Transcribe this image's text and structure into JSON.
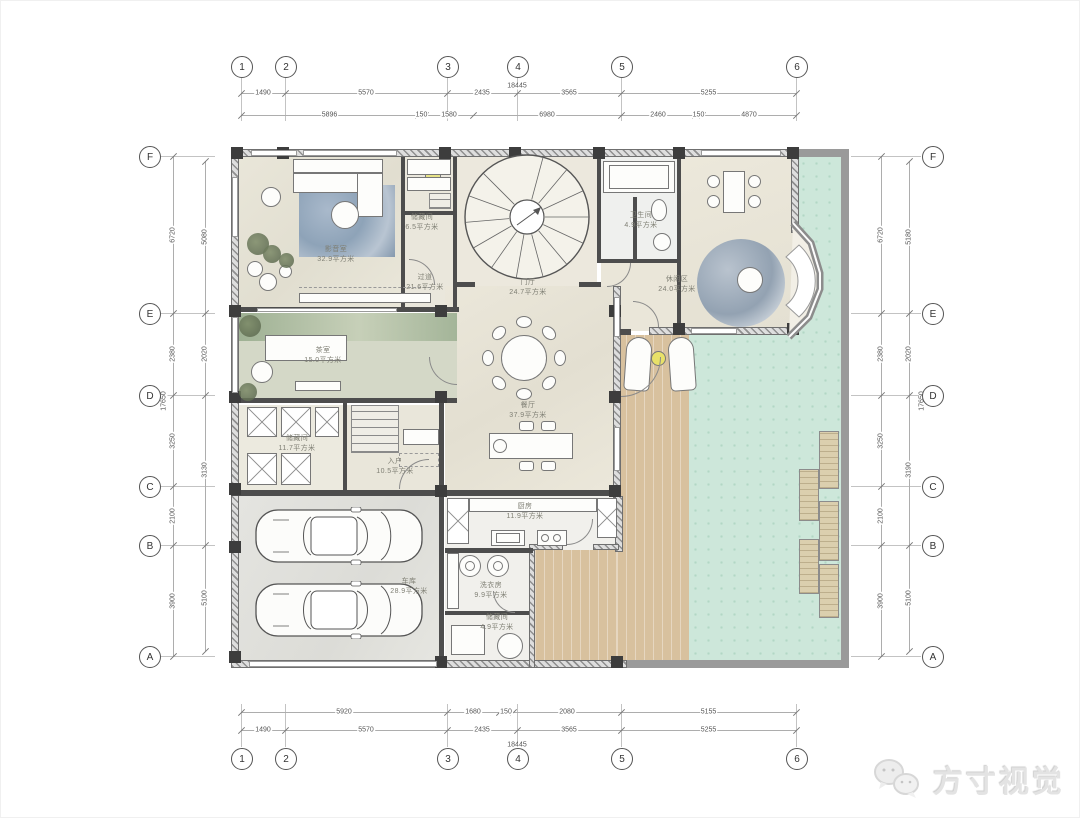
{
  "watermark": {
    "brand": "方寸视觉",
    "icon": "wechat-icon"
  },
  "grid": {
    "top": {
      "y": 65,
      "leader": [
        77,
        120
      ],
      "items": [
        {
          "label": "1",
          "x": 240
        },
        {
          "label": "2",
          "x": 284
        },
        {
          "label": "3",
          "x": 446
        },
        {
          "label": "4",
          "x": 516
        },
        {
          "label": "5",
          "x": 620
        },
        {
          "label": "6",
          "x": 795
        }
      ]
    },
    "bottom": {
      "y": 757,
      "leader": [
        703,
        746
      ],
      "items": [
        {
          "label": "1",
          "x": 240
        },
        {
          "label": "2",
          "x": 284
        },
        {
          "label": "3",
          "x": 446
        },
        {
          "label": "4",
          "x": 516
        },
        {
          "label": "5",
          "x": 620
        },
        {
          "label": "6",
          "x": 795
        }
      ]
    },
    "left": {
      "x": 148,
      "leader": [
        160,
        214
      ],
      "items": [
        {
          "label": "F",
          "y": 155
        },
        {
          "label": "E",
          "y": 312
        },
        {
          "label": "D",
          "y": 394
        },
        {
          "label": "C",
          "y": 485
        },
        {
          "label": "B",
          "y": 544
        },
        {
          "label": "A",
          "y": 655
        }
      ]
    },
    "right": {
      "x": 931,
      "leader": [
        850,
        920
      ],
      "items": [
        {
          "label": "F",
          "y": 155
        },
        {
          "label": "E",
          "y": 312
        },
        {
          "label": "D",
          "y": 394
        },
        {
          "label": "C",
          "y": 485
        },
        {
          "label": "B",
          "y": 544
        },
        {
          "label": "A",
          "y": 655
        }
      ]
    }
  },
  "dims": [
    {
      "o": "h",
      "y": 92,
      "s": 240,
      "e": 795,
      "segs": [
        {
          "v": "1490",
          "a": 240,
          "b": 284
        },
        {
          "v": "5570",
          "a": 284,
          "b": 446
        },
        {
          "v": "2435",
          "a": 446,
          "b": 516
        },
        {
          "v": "3565",
          "a": 516,
          "b": 620
        },
        {
          "v": "5255",
          "a": 620,
          "b": 795
        }
      ]
    },
    {
      "o": "h",
      "y": 114,
      "s": 240,
      "e": 795,
      "segs": [
        {
          "v": "5896",
          "a": 240,
          "b": 417
        },
        {
          "v": "150",
          "a": 417,
          "b": 424
        },
        {
          "v": "1580",
          "a": 424,
          "b": 472
        },
        {
          "v": "6980",
          "a": 472,
          "b": 620
        },
        {
          "v": "2460",
          "a": 620,
          "b": 694
        },
        {
          "v": "150",
          "a": 694,
          "b": 701
        },
        {
          "v": "4870",
          "a": 701,
          "b": 795
        }
      ]
    },
    {
      "o": "h",
      "y": 711,
      "s": 240,
      "e": 795,
      "segs": [
        {
          "v": "5920",
          "a": 240,
          "b": 446
        },
        {
          "v": "1680",
          "a": 446,
          "b": 498
        },
        {
          "v": "150",
          "a": 498,
          "b": 512
        },
        {
          "v": "2080",
          "a": 512,
          "b": 620
        },
        {
          "v": "5155",
          "a": 620,
          "b": 795
        }
      ]
    },
    {
      "o": "h",
      "y": 729,
      "s": 240,
      "e": 795,
      "segs": [
        {
          "v": "1490",
          "a": 240,
          "b": 284
        },
        {
          "v": "5570",
          "a": 284,
          "b": 446
        },
        {
          "v": "2435",
          "a": 446,
          "b": 516
        },
        {
          "v": "3565",
          "a": 516,
          "b": 620
        },
        {
          "v": "5255",
          "a": 620,
          "b": 795
        }
      ]
    },
    {
      "o": "v",
      "x": 172,
      "s": 155,
      "e": 655,
      "segs": [
        {
          "v": "6720",
          "a": 155,
          "b": 312
        },
        {
          "v": "2380",
          "a": 312,
          "b": 394
        },
        {
          "v": "3250",
          "a": 394,
          "b": 485
        },
        {
          "v": "2100",
          "a": 485,
          "b": 544
        },
        {
          "v": "3900",
          "a": 544,
          "b": 655
        }
      ]
    },
    {
      "o": "v",
      "x": 204,
      "s": 160,
      "e": 650,
      "segs": [
        {
          "v": "5080",
          "a": 160,
          "b": 312
        },
        {
          "v": "2020",
          "a": 312,
          "b": 394
        },
        {
          "v": "3130",
          "a": 394,
          "b": 544
        },
        {
          "v": "5100",
          "a": 544,
          "b": 650
        }
      ]
    },
    {
      "o": "v",
      "x": 880,
      "s": 155,
      "e": 655,
      "segs": [
        {
          "v": "6720",
          "a": 155,
          "b": 312
        },
        {
          "v": "2380",
          "a": 312,
          "b": 394
        },
        {
          "v": "3250",
          "a": 394,
          "b": 485
        },
        {
          "v": "2100",
          "a": 485,
          "b": 544
        },
        {
          "v": "3900",
          "a": 544,
          "b": 655
        }
      ]
    },
    {
      "o": "v",
      "x": 908,
      "s": 160,
      "e": 650,
      "segs": [
        {
          "v": "5180",
          "a": 160,
          "b": 312
        },
        {
          "v": "2020",
          "a": 312,
          "b": 394
        },
        {
          "v": "3190",
          "a": 394,
          "b": 544
        },
        {
          "v": "5100",
          "a": 544,
          "b": 650
        }
      ]
    }
  ],
  "dim_totals": [
    {
      "text": "18445",
      "x": 516,
      "y": 85,
      "rot": 0
    },
    {
      "text": "18445",
      "x": 516,
      "y": 744,
      "rot": 0
    },
    {
      "text": "17650",
      "x": 163,
      "y": 400,
      "rot": -90
    },
    {
      "text": "17650",
      "x": 921,
      "y": 400,
      "rot": -90
    }
  ],
  "rooms": [
    {
      "name": "影音室",
      "area": "32.9平方米",
      "x": 335,
      "y": 254
    },
    {
      "name": "储藏间",
      "area": "6.5平方米",
      "x": 421,
      "y": 222
    },
    {
      "name": "过道",
      "area": "21.6平方米",
      "x": 424,
      "y": 282
    },
    {
      "name": "门厅",
      "area": "24.7平方米",
      "x": 527,
      "y": 287
    },
    {
      "name": "卫生间",
      "area": "4.9平方米",
      "x": 640,
      "y": 220
    },
    {
      "name": "休闲区",
      "area": "24.0平方米",
      "x": 676,
      "y": 284
    },
    {
      "name": "餐厅",
      "area": "37.9平方米",
      "x": 527,
      "y": 410
    },
    {
      "name": "茶室",
      "area": "15.0平方米",
      "x": 322,
      "y": 355
    },
    {
      "name": "储藏间",
      "area": "11.7平方米",
      "x": 296,
      "y": 443
    },
    {
      "name": "入户",
      "area": "10.5平方米",
      "x": 394,
      "y": 466
    },
    {
      "name": "车库",
      "area": "28.9平方米",
      "x": 408,
      "y": 586
    },
    {
      "name": "厨房",
      "area": "11.9平方米",
      "x": 524,
      "y": 511
    },
    {
      "name": "洗衣房",
      "area": "9.9平方米",
      "x": 490,
      "y": 590
    },
    {
      "name": "储藏间",
      "area": "4.9平方米",
      "x": 496,
      "y": 622
    }
  ],
  "colors": {
    "garden": "#cde7da",
    "deck": "#d8c19e",
    "wall": "#4d4d4d",
    "accent_yellow": "#e7e388",
    "rug_blue": "#93a7bd"
  }
}
